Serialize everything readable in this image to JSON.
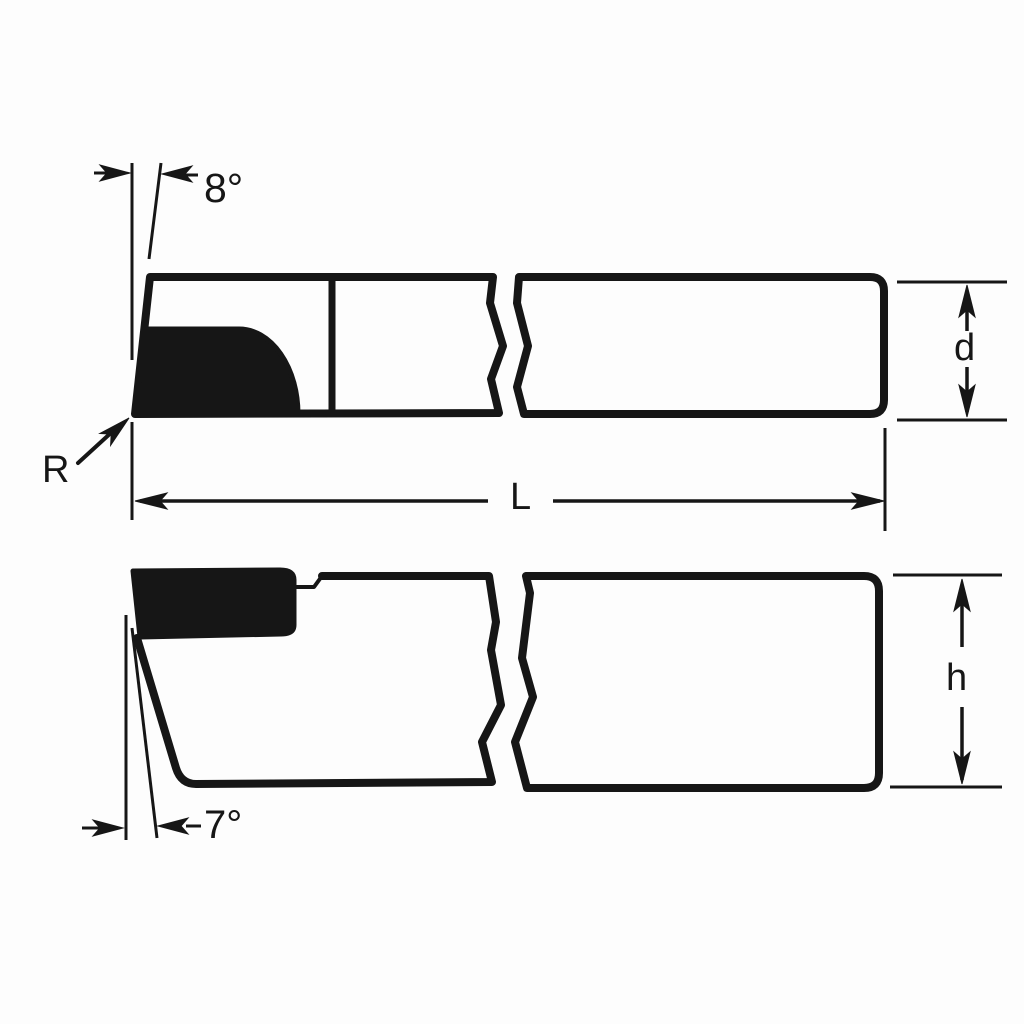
{
  "diagram": {
    "ink_color": "#161616",
    "paper_color": "#fdfdfd",
    "top_view": {
      "angle_label": "8°",
      "nose_radius_label": "R",
      "width_label": "d"
    },
    "length_label": "L",
    "side_view": {
      "angle_label": "7°",
      "height_label": "h"
    }
  }
}
